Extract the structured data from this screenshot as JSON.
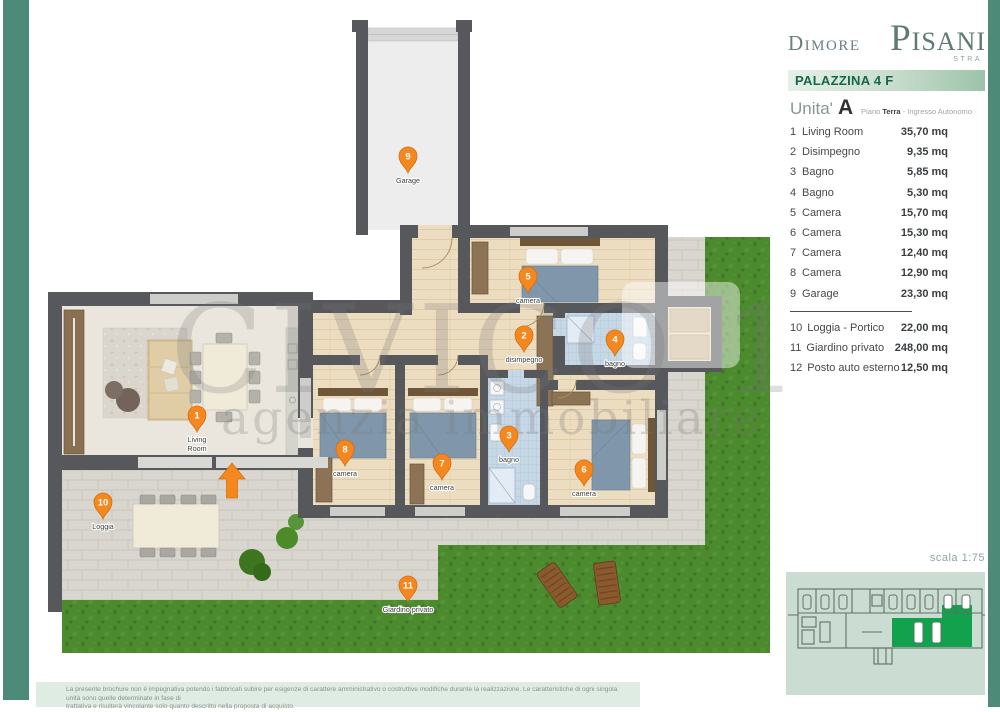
{
  "brand": {
    "name_small": "Dimore",
    "name_large": "Pisani",
    "subtitle": "STRA"
  },
  "panel": {
    "building_label": "PALAZZINA 4 F",
    "unit": {
      "label": "Unita'",
      "letter": "A",
      "floor_prefix": "Piano",
      "floor_name": "Terra",
      "floor_suffix": "- Ingresso Autonomo"
    },
    "rooms": [
      {
        "num": "1",
        "name": "Living Room",
        "area": "35,70 mq"
      },
      {
        "num": "2",
        "name": "Disimpegno",
        "area": "9,35 mq"
      },
      {
        "num": "3",
        "name": "Bagno",
        "area": "5,85 mq"
      },
      {
        "num": "4",
        "name": "Bagno",
        "area": "5,30 mq"
      },
      {
        "num": "5",
        "name": "Camera",
        "area": "15,70 mq"
      },
      {
        "num": "6",
        "name": "Camera",
        "area": "15,30 mq"
      },
      {
        "num": "7",
        "name": "Camera",
        "area": "12,40 mq"
      },
      {
        "num": "8",
        "name": "Camera",
        "area": "12,90 mq"
      },
      {
        "num": "9",
        "name": "Garage",
        "area": "23,30 mq"
      }
    ],
    "outdoor": [
      {
        "num": "10",
        "name": "Loggia - Portico",
        "area": "22,00 mq"
      },
      {
        "num": "11",
        "name": "Giardino privato",
        "area": "248,00 mq"
      },
      {
        "num": "12",
        "name": "Posto auto esterno",
        "area": "12,50 mq"
      }
    ],
    "scale_note": "scala 1:75"
  },
  "plan": {
    "watermark": {
      "title": "CIVICO 1",
      "subtitle": "agenzia immobiliare"
    },
    "pins": [
      {
        "num": "1",
        "label": "Living Room",
        "line1": "Living",
        "line2": "Room"
      },
      {
        "num": "2",
        "label": "disimpegno"
      },
      {
        "num": "3",
        "label": "bagno"
      },
      {
        "num": "4",
        "label": "bagno"
      },
      {
        "num": "5",
        "label": "camera"
      },
      {
        "num": "6",
        "label": "camera"
      },
      {
        "num": "7",
        "label": "camera"
      },
      {
        "num": "8",
        "label": "camera"
      },
      {
        "num": "9",
        "label": "Garage"
      },
      {
        "num": "10",
        "label": "Loggia"
      },
      {
        "num": "11",
        "label": "Giardino privato"
      }
    ]
  },
  "footer": {
    "line1": "La presente brochure non è impegnativa potendo i fabbricati subire per esigenze di carattere amministrativo o costruttive modifiche durante la realizzazione. Le caratteristiche di ogni singola unità sono quelle determinate in fase di",
    "line2": "trattativa e risulterà vincolante solo quanto descritto nella proposta di acquisto."
  },
  "colors": {
    "teal": "#4e8a78",
    "pin_orange": "#f5871f",
    "wall": "#57585c",
    "grass": "#4c8a2e",
    "highlight_green": "#12a14c",
    "bar_green": "#9cc3aa"
  }
}
